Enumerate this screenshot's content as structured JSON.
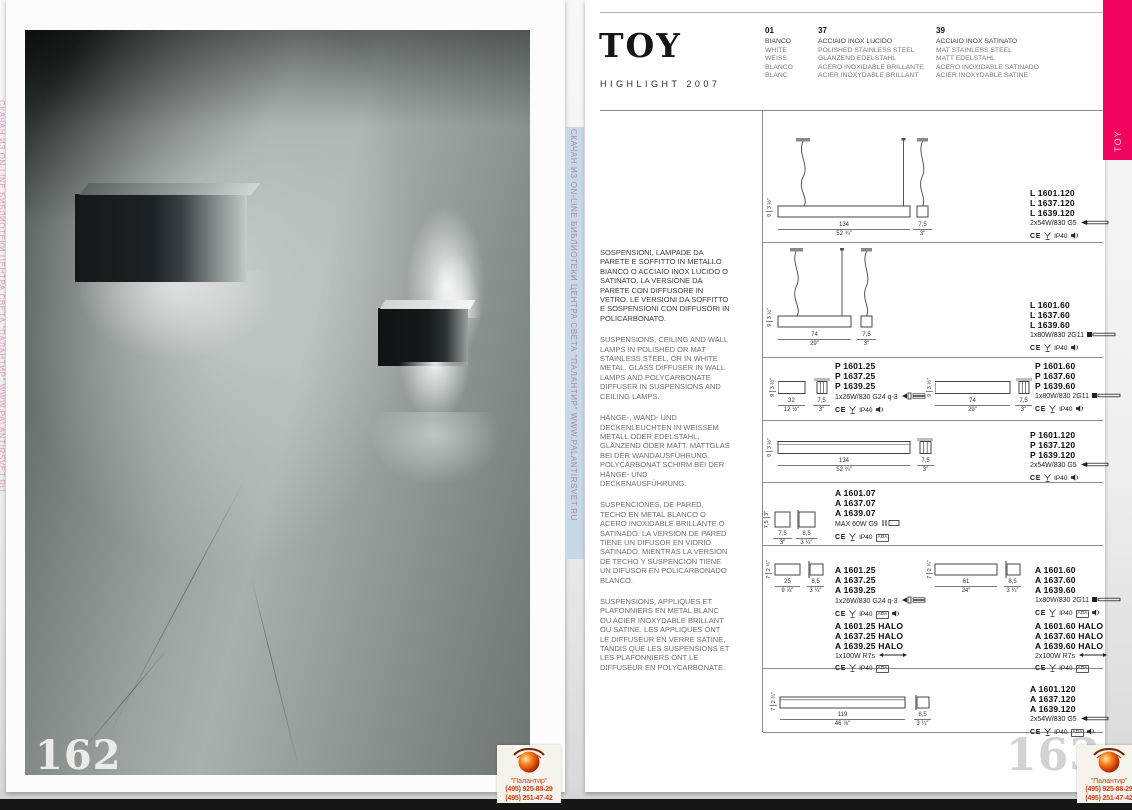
{
  "pages": {
    "left_number": "162",
    "right_number": "163"
  },
  "watermark": {
    "strip_text": "СКАЧАН ИЗ ON-LINE БИБЛИОТЕКИ ЦЕНТРА СВЕТА \"ПАЛАНТИР\"   WWW.PALANTIRSVET.RU",
    "logo": {
      "name": "\"Палантир\"",
      "phone1": "(495) 925-88-29",
      "phone2": "(495) 251-47-42"
    }
  },
  "header": {
    "title": "TOY",
    "subtitle": "HIGHLIGHT 2007",
    "tab_label": "TOY",
    "accent_color": "#f2045e",
    "finishes": [
      {
        "code": "01",
        "names": [
          "BIANCO",
          "WHITE",
          "WEISS",
          "BLANCO",
          "BLANC"
        ]
      },
      {
        "code": "37",
        "names": [
          "ACCIAIO INOX LUCIDO",
          "POLISHED STAINLESS STEEL",
          "GLÄNZEND EDELSTAHL",
          "ACERO INOXIDABLE BRILLANTE",
          "ACIER INOXYDABLE BRILLANT"
        ]
      },
      {
        "code": "39",
        "names": [
          "ACCIAIO INOX SATINATO",
          "MAT STAINLESS STEEL",
          "MATT EDELSTAHL",
          "ACERO INOXIDABLE SATINADO",
          "ACIER INOXYDABLE SATINE"
        ]
      }
    ]
  },
  "description": {
    "it": "SOSPENSIONI, LAMPADE DA PARETE E SOFFITTO IN METALLO  BIANCO O ACCIAIO INOX LUCIDO O SATINATO. LA VERSIONE DA PARETE CON DIFFUSORE IN VETRO. LE VERSIONI DA SOFFITTO E SOSPENSIONI CON DIFFUSORI IN POLICARBONATO.",
    "en": "SUSPENSIONS, CEILING AND WALL LAMPS IN POLISHED OR MAT STAINLESS STEEL, OR IN WHITE METAL. GLASS DIFFUSER IN WALL LAMPS AND POLYCARBONATE DIFFUSER IN SUSPENSIONS AND CEILING LAMPS.",
    "de": "HÄNGE-, WAND- UND DECKENLEUCHTEN IN WEISSEM METALL  ODER EDELSTAHL, GLÄNZEND ODER MATT. MATTGLAS BEI DER WANDAUSFÜHRUNG. POLYCARBONAT SCHIRM BEI DER HÄNGE- UND DECKENAUSFÜHRUNG.",
    "es": "SUSPENCIONES, DE PARED, TECHO EN METAL BLANCO O ACERO INOXIDABLE BRILLANTE O SATINADO. LA VERSION DE PARED TIENE UN DIFUSOR EN VIDRIO SATINADO, MIENTRAS LA VERSION DE TECHO Y SUSPENCION TIENE UN DIFUSOR EN POLICARBONADO BLANCO.",
    "fr": "SUSPENSIONS, APPLIQUES ET PLAFONNIERS EN METAL BLANC OU ACIER INOXYDABLE BRILLANT OU SATINE. LES APPLIQUES ONT LE DIFFUSEUR EN VERRE SATINE, TANDIS QUE LES SUSPENSIONS ET LES PLAFONNIERS ONT LE DIFFUSEUR EN POLYCARBONATE."
  },
  "labels": {
    "ce": "CE",
    "ip": "IP40",
    "ada": "ADA"
  },
  "specs": {
    "rows": [
      {
        "codes": [
          "L 1601.120",
          "L 1637.120",
          "L 1639.120"
        ],
        "lamp": "2x54W/830 G5",
        "dims": {
          "h": "9",
          "h_in": "3 ½″",
          "w": "134",
          "w_in": "52 ¾″",
          "s": "7,5",
          "s_in": "3″"
        }
      },
      {
        "codes": [
          "L 1601.60",
          "L 1637.60",
          "L 1639.60"
        ],
        "lamp": "1x80W/830 2G11",
        "dims": {
          "h": "9",
          "h_in": "3 ½″",
          "w": "74",
          "w_in": "29″",
          "s": "7,5",
          "s_in": "3″"
        }
      },
      {
        "codes": [
          "P 1601.25",
          "P 1637.25",
          "P 1639.25"
        ],
        "lamp": "1x26W/830 G24 q-3",
        "dims": {
          "h": "9",
          "h_in": "3 ½″",
          "w": "32",
          "w_in": "12 ½″",
          "s": "7,5",
          "s_in": "3″"
        }
      },
      {
        "codes": [
          "P 1601.60",
          "P 1637.60",
          "P 1639.60"
        ],
        "lamp": "1x80W/830 2G11",
        "dims": {
          "h": "9",
          "h_in": "3 ½″",
          "w": "74",
          "w_in": "29″",
          "s": "7,5",
          "s_in": "3″"
        }
      },
      {
        "codes": [
          "P 1601.120",
          "P 1637.120",
          "P 1639.120"
        ],
        "lamp": "2x54W/830 G5",
        "dims": {
          "h": "9",
          "h_in": "3 ½″",
          "w": "134",
          "w_in": "52 ¾″",
          "s": "7,5",
          "s_in": "3″"
        }
      },
      {
        "codes": [
          "A 1601.07",
          "A 1637.07",
          "A 1639.07"
        ],
        "lamp": "MAX 60W G9",
        "dims": {
          "h": "7,5",
          "h_in": "3″",
          "w": "7,5",
          "w_in": "3″",
          "s": "8,5",
          "s_in": "3 ¼″"
        }
      },
      {
        "codes": [
          "A 1601.25",
          "A 1637.25",
          "A 1639.25"
        ],
        "lamp": "1x26W/830 G24 q-3",
        "dims": {
          "h": "7",
          "h_in": "2 ¾″",
          "w": "25",
          "w_in": "9 ⅞″",
          "s": "8,5",
          "s_in": "3 ¼″"
        }
      },
      {
        "codes": [
          "A 1601.60",
          "A 1637.60",
          "A 1639.60"
        ],
        "lamp": "1x80W/830 2G11",
        "dims": {
          "h": "7",
          "h_in": "2 ¾″",
          "w": "61",
          "w_in": "24″",
          "s": "8,5",
          "s_in": "3 ¼″"
        }
      },
      {
        "codes": [
          "A 1601.25 HALO",
          "A 1637.25 HALO",
          "A 1639.25 HALO"
        ],
        "lamp": "1x100W R7s",
        "dims": {}
      },
      {
        "codes": [
          "A 1601.60 HALO",
          "A 1637.60 HALO",
          "A 1639.60 HALO"
        ],
        "lamp": "2x100W R7s",
        "dims": {}
      },
      {
        "codes": [
          "A 1601.120",
          "A 1637.120",
          "A 1639.120"
        ],
        "lamp": "2x54W/830 G5",
        "dims": {
          "h": "7",
          "h_in": "2 ¾″",
          "w": "119",
          "w_in": "46 ⅞″",
          "s": "8,5",
          "s_in": "3 ¼″"
        }
      }
    ]
  }
}
